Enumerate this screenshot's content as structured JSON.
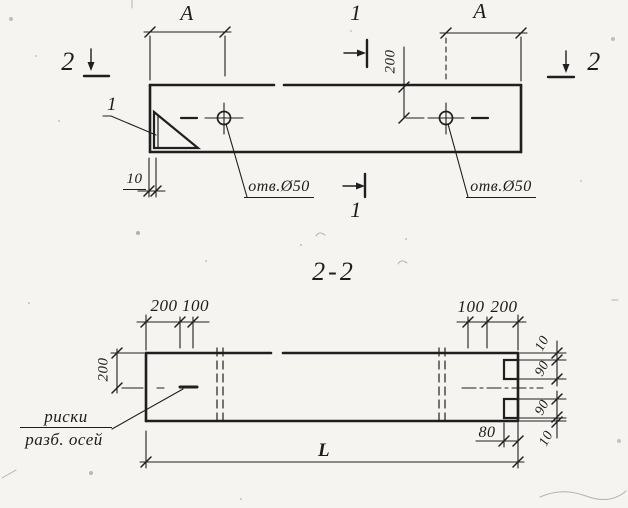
{
  "drawing": {
    "top_view": {
      "span_dim_left": "A",
      "span_dim_right": "A",
      "hole_offset_dim": "200",
      "plate_thickness_dim": "10",
      "hole_label_left": "отв.Ø50",
      "hole_label_right": "отв.Ø50",
      "detail_callout": "1",
      "section_cut_1_top": "1",
      "section_cut_1_bottom": "1",
      "section_cut_2_left": "2",
      "section_cut_2_right": "2"
    },
    "section_view": {
      "title": "2-2",
      "top_dims_left": [
        "200",
        "100"
      ],
      "top_dims_right": [
        "100",
        "200"
      ],
      "half_height_dim": "200",
      "end_face_dims": [
        "10",
        "90",
        "90",
        "10"
      ],
      "notch_depth_dim": "80",
      "length_dim": "L",
      "axis_marks_label": [
        "риски",
        "разб. осей"
      ]
    }
  }
}
